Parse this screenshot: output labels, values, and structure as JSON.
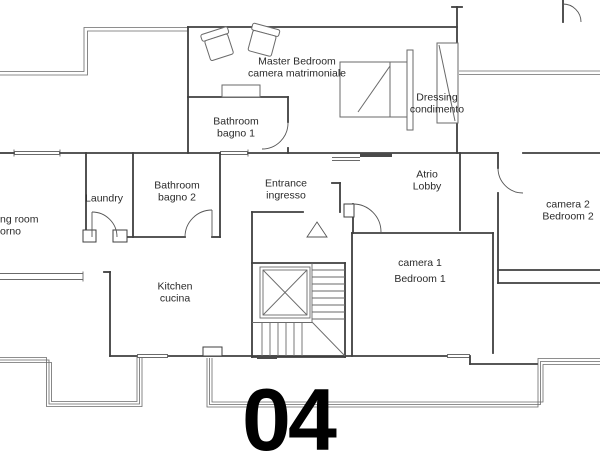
{
  "drawing_type": "apartment floor plan",
  "unit_number": "04",
  "rooms": {
    "master_bedroom": {
      "line1": "Master Bedroom",
      "line2": "camera matrimoniale"
    },
    "dressing": {
      "line1": "Dressing",
      "line2": "condimento"
    },
    "bathroom1": {
      "line1": "Bathroom",
      "line2": "bagno 1"
    },
    "laundry": {
      "line1": "Laundry"
    },
    "bathroom2": {
      "line1": "Bathroom",
      "line2": "bagno 2"
    },
    "entrance": {
      "line1": "Entrance",
      "line2": "ingresso"
    },
    "atrio": {
      "line1": "Atrio",
      "line2": "Lobby"
    },
    "living_room_partial": {
      "line1": "ng room",
      "line2": "orno"
    },
    "kitchen": {
      "line1": "Kitchen",
      "line2": "cucina"
    },
    "camera1": {
      "line1": "camera 1",
      "line2": "Bedroom 1"
    },
    "camera2": {
      "line1": "camera 2",
      "line2": "Bedroom 2"
    }
  },
  "colors": {
    "background": "#ffffff",
    "wall_line": "#3f3f3f",
    "thin_line": "#6a6a6a",
    "label_text": "#2a2a2a",
    "unit_number_text": "#000000"
  }
}
